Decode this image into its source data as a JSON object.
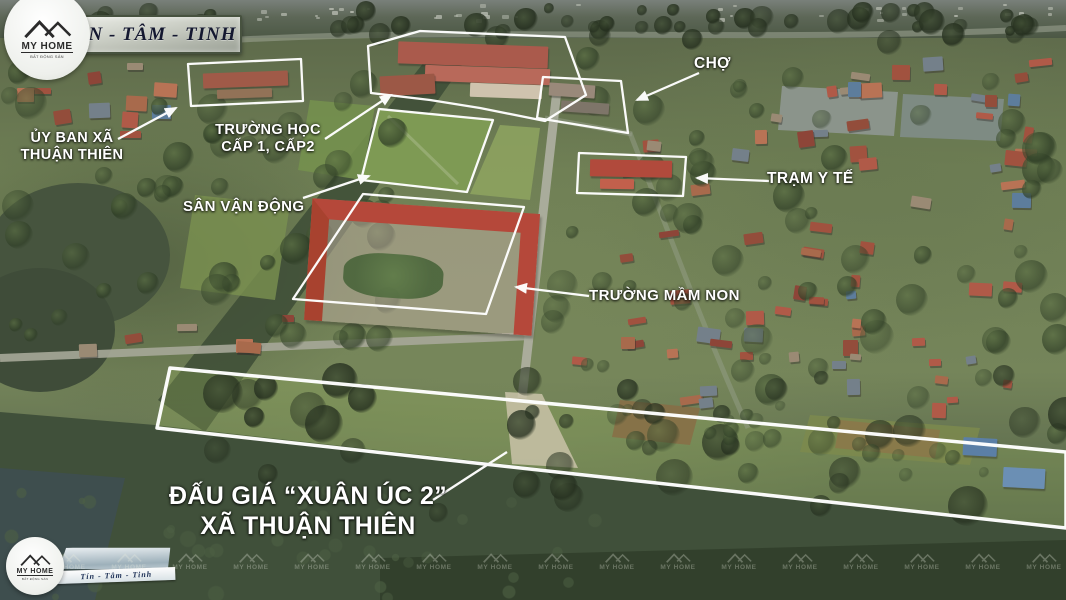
{
  "branding": {
    "name": "MY HOME",
    "tagline": "BẤT ĐỘNG SẢN",
    "banner_slogan": "TÍN - TÂM - TINH",
    "ribbon_slogan": "Tín - Tâm - Tinh"
  },
  "annotations": {
    "committee": {
      "line1": "ỦY BAN XÃ",
      "line2": "THUẬN THIÊN"
    },
    "school": {
      "line1": "TRƯỜNG HỌC",
      "line2": "CẤP 1, CẤP2"
    },
    "stadium": {
      "label": "SÂN VẬN ĐỘNG"
    },
    "market": {
      "label": "CHỢ"
    },
    "clinic": {
      "label": "TRẠM Y TẾ"
    },
    "kindergarten": {
      "label": "TRƯỜNG MẦM NON"
    },
    "auction_title": {
      "line1": "ĐẤU GIÁ “XUÂN ÚC 2”",
      "line2": "XÃ THUẬN THIÊN"
    }
  },
  "watermark": {
    "text": "MY HOME"
  },
  "colors": {
    "annotation_white": "#ffffff",
    "banner_text": "#141830",
    "highlight_roof": "#b5483a",
    "stadium_green": "#7e9a54"
  }
}
